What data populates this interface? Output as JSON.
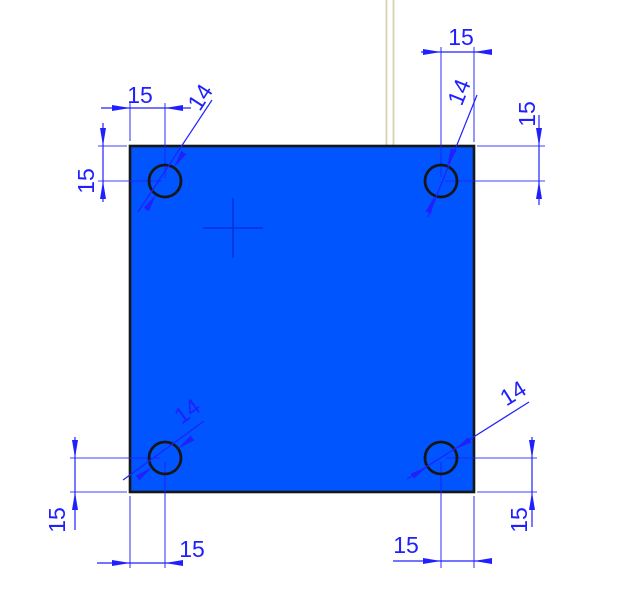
{
  "drawing": {
    "dims": {
      "top_left_horizontal": {
        "label": "15"
      },
      "top_left_vertical": {
        "label": "15"
      },
      "top_right_horizontal": {
        "label": "15"
      },
      "top_right_vertical": {
        "label": "15"
      },
      "bottom_left_vertical": {
        "label": "15"
      },
      "bottom_left_horizontal": {
        "label": "15"
      },
      "bottom_right_vertical": {
        "label": "15"
      },
      "bottom_right_horizontal": {
        "label": "15"
      }
    },
    "hole_diameters": {
      "top_left": {
        "label": "14"
      },
      "top_right": {
        "label": "14"
      },
      "bottom_left": {
        "label": "14"
      },
      "bottom_right": {
        "label": "14"
      }
    }
  },
  "colors": {
    "background": "#ffffff",
    "plate_fill": "#0055ff",
    "outline": "#161616",
    "dimension": "#2020ff",
    "construction": "#d8d3b3",
    "center_mark": "#0033dd"
  }
}
